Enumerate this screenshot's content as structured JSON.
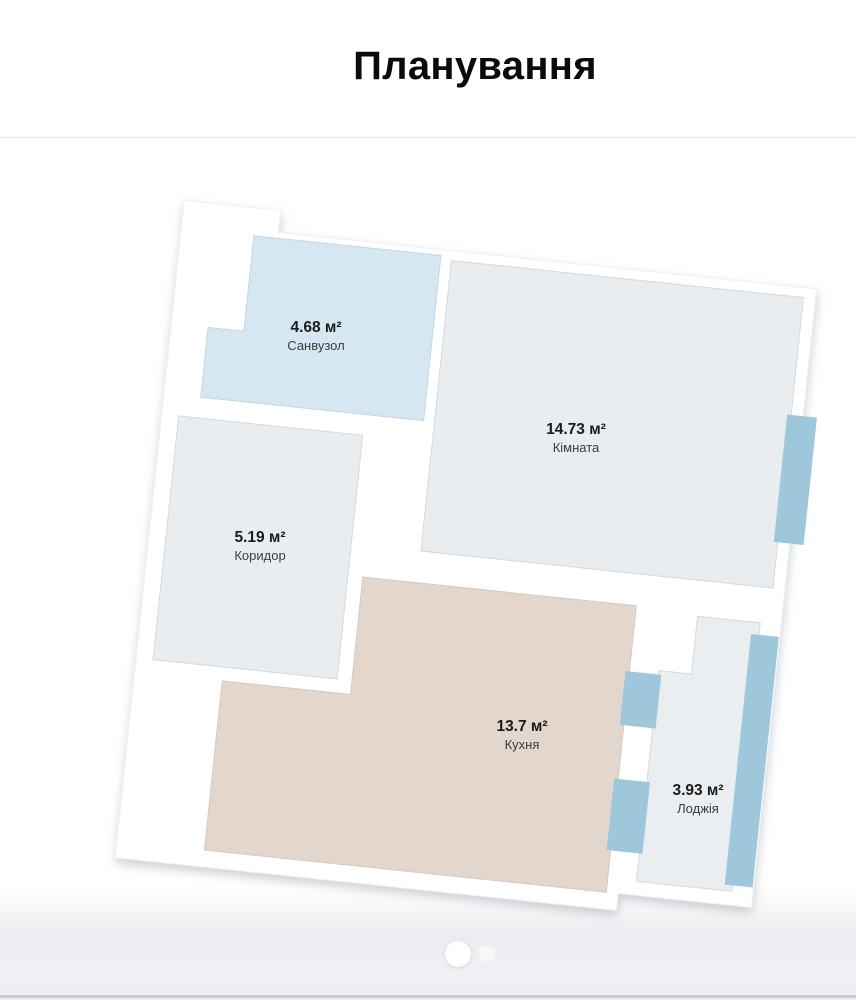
{
  "title": "Планування",
  "rooms": [
    {
      "id": "bathroom",
      "area": "4.68 м²",
      "name": "Санвузол",
      "color": "#d5e8f2"
    },
    {
      "id": "room",
      "area": "14.73 м²",
      "name": "Кімната",
      "color": "#e9edf0"
    },
    {
      "id": "corridor",
      "area": "5.19 м²",
      "name": "Коридор",
      "color": "#e9edf0"
    },
    {
      "id": "kitchen",
      "area": "13.7 м²",
      "name": "Кухня",
      "color": "#e2d6cd"
    },
    {
      "id": "loggia",
      "area": "3.93 м²",
      "name": "Лоджія",
      "color": "#eaeef1"
    }
  ],
  "colors": {
    "wall": "#ffffff",
    "window": "#9fc7db",
    "room_outline": "#cfd8dd",
    "shadow": "#99a4ae"
  },
  "pagination": {
    "dots": [
      {
        "state": "active"
      },
      {
        "state": "inactive"
      }
    ]
  }
}
